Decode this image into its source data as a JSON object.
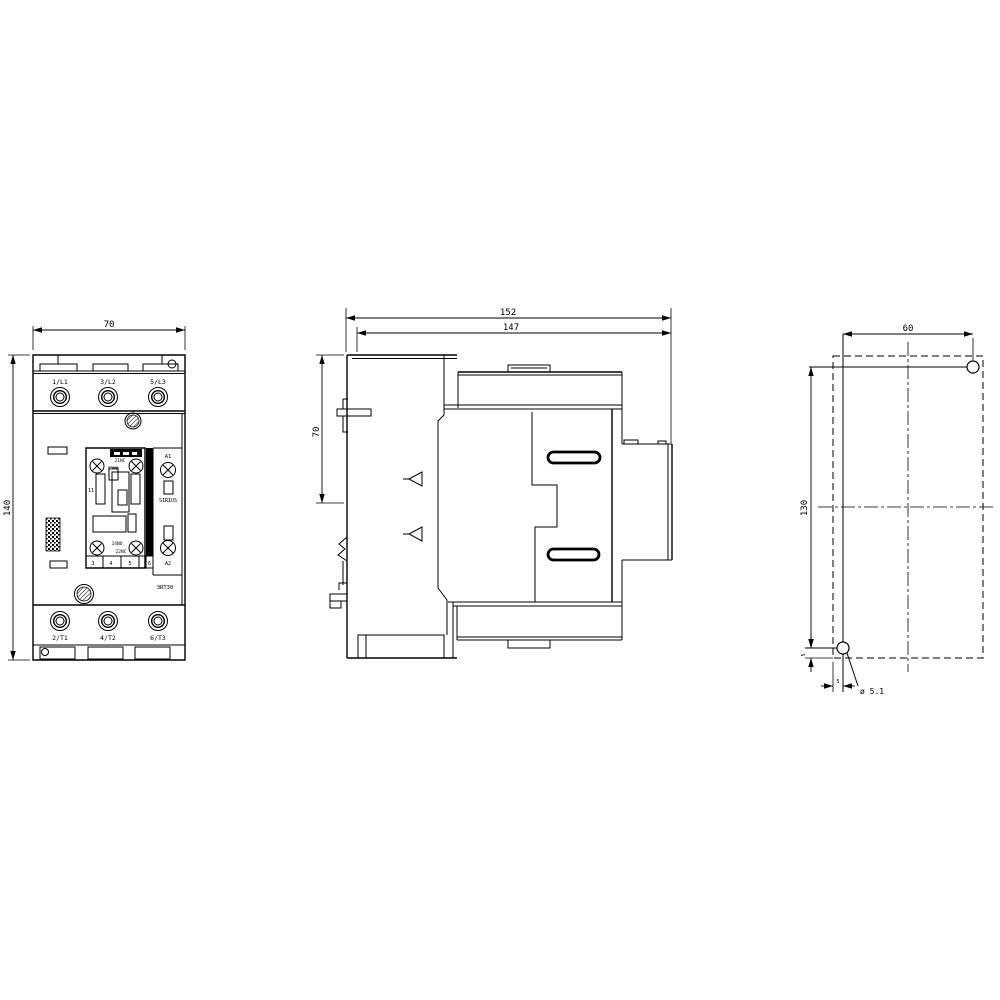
{
  "front_view": {
    "dim_width": "70",
    "dim_height": "140",
    "top_terminals": [
      "1/L1",
      "3/L2",
      "5/L3"
    ],
    "bottom_terminals": [
      "2/T1",
      "4/T2",
      "6/T3"
    ],
    "aux_top": {
      "nc": "21NC",
      "no": "13NO"
    },
    "aux_bottom": {
      "no": "14NO",
      "nc": "22NC"
    },
    "coil_top": "A1",
    "coil_bottom": "A2",
    "brand": "SIRIUS",
    "series": "3RT30",
    "pole_mark": "11",
    "size_row": [
      "3",
      "4",
      "5",
      "6"
    ]
  },
  "side_view": {
    "dim_total_depth": "152",
    "dim_body_depth": "147",
    "dim_rail_height": "70"
  },
  "drill_plan": {
    "dim_h": "60",
    "dim_v": "130",
    "dim_edge_v": "5",
    "dim_edge_h": "5",
    "hole_dia": "ø 5.1"
  },
  "colors": {
    "line": "#000000",
    "background": "#ffffff"
  }
}
